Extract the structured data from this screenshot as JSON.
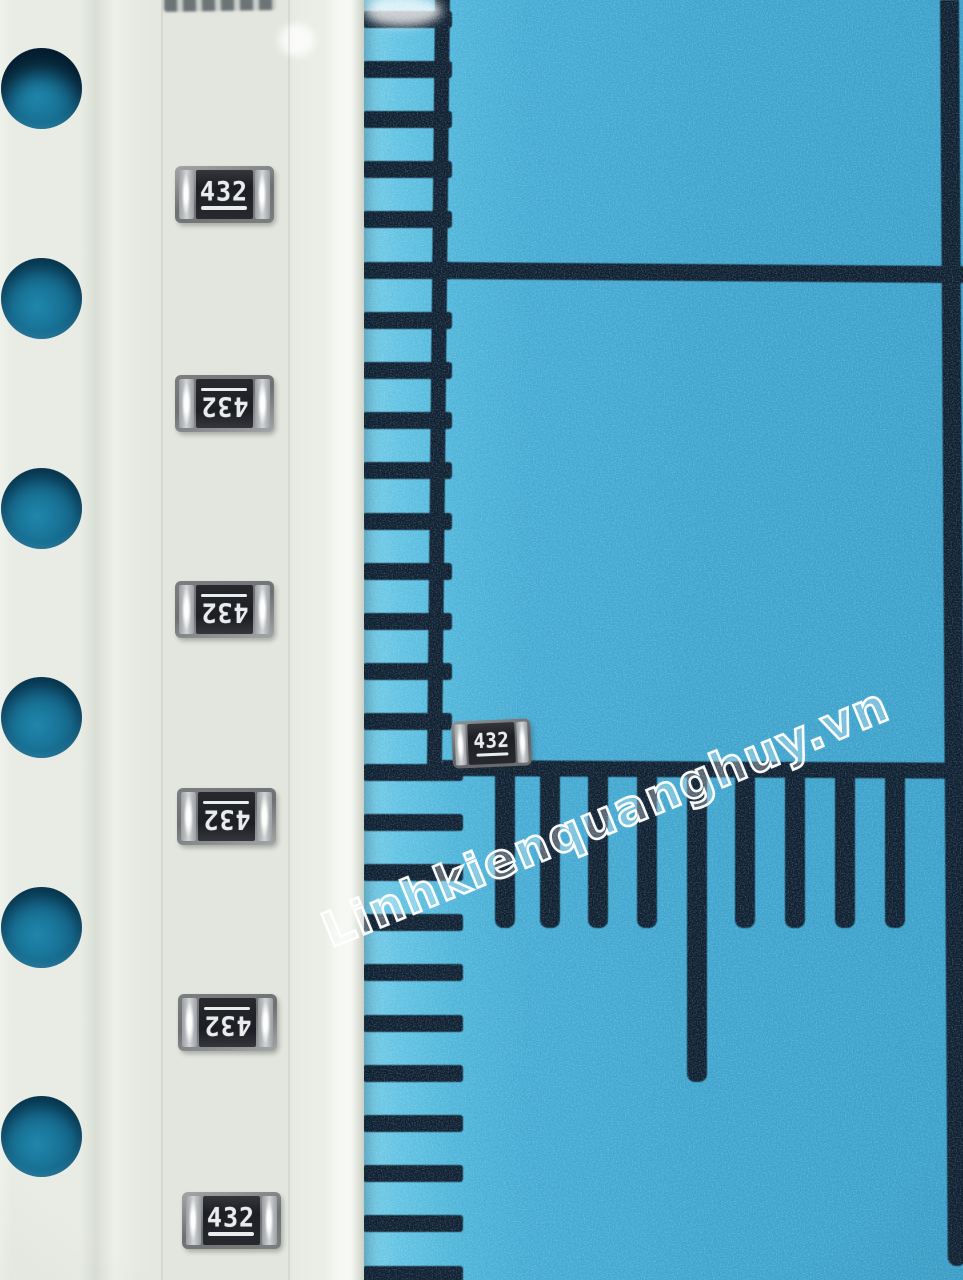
{
  "watermark": {
    "text": "Linhkienquanghuy.vn"
  },
  "tape": {
    "sprocket_hole_count": 6,
    "sprocket_hole_centers_y": [
      88,
      298,
      508,
      717,
      927,
      1136
    ],
    "resistors": [
      {
        "marking": "432",
        "orientation": "upright",
        "cx": 224,
        "cy": 194
      },
      {
        "marking": "432",
        "orientation": "rotated-180",
        "cx": 224,
        "cy": 403
      },
      {
        "marking": "432",
        "orientation": "rotated-180",
        "cx": 224,
        "cy": 609
      },
      {
        "marking": "432",
        "orientation": "rotated-180",
        "cx": 226,
        "cy": 816
      },
      {
        "marking": "432",
        "orientation": "rotated-180",
        "cx": 227,
        "cy": 1022
      },
      {
        "marking": "432",
        "orientation": "upright",
        "cx": 231,
        "cy": 1220
      }
    ]
  },
  "loose_resistor": {
    "marking": "432",
    "orientation": "upright"
  },
  "ruler": {
    "left_ticks": {
      "count": 26,
      "start_y": 19,
      "spacing": 50.2
    },
    "bottom_ticks": {
      "centers_x": [
        505,
        550,
        598,
        647,
        697,
        745,
        795,
        845,
        895
      ],
      "long_tick_x": 697
    }
  },
  "colors": {
    "mat_blue": "#3fa6cf",
    "mat_blue_light": "#5ec2e2",
    "grid_navy": "#0c1e30",
    "tape_white": "#e9ece5",
    "hole_teal": "#15688c",
    "chip_frame": "#85878a",
    "chip_body": "#1c1e23",
    "terminal_silver": "#d2d5d6",
    "marking_white": "#e9ecec",
    "watermark_white": "#ffffff"
  }
}
